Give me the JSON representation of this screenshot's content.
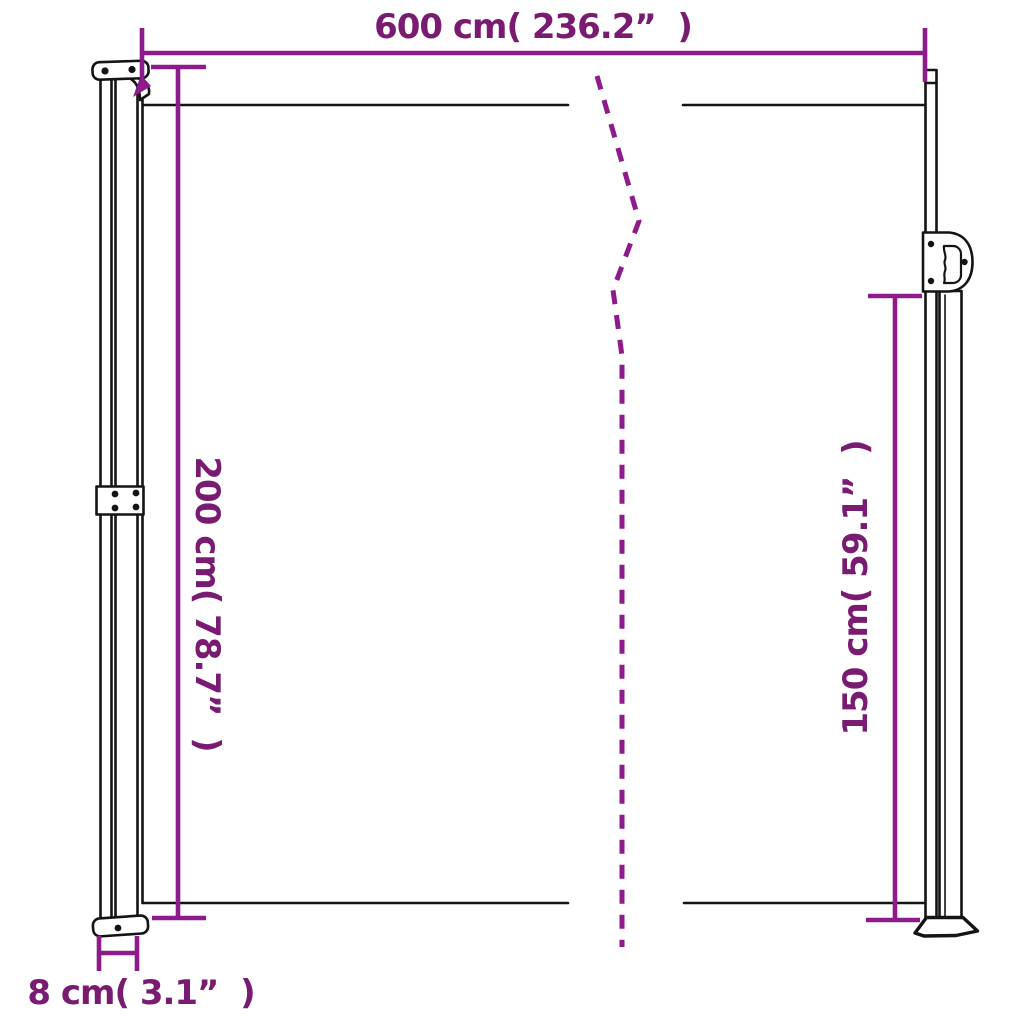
{
  "colors": {
    "background": "#ffffff",
    "drawing": "#141414",
    "dimension_line": "#8e1b8b",
    "label_text": "#7a1b72"
  },
  "labels": {
    "width": "600 cm( 236.2”  )",
    "height_left": "200 cm( 78.7”  )",
    "height_right": "150 cm( 59.1”  )",
    "post_width": "8 cm( 3.1”  )"
  },
  "measurements": {
    "width": {
      "cm": 600,
      "inch": 236.2
    },
    "height_left": {
      "cm": 200,
      "inch": 78.7
    },
    "height_right": {
      "cm": 150,
      "inch": 59.1
    },
    "post_width": {
      "cm": 8,
      "inch": 3.1
    }
  }
}
